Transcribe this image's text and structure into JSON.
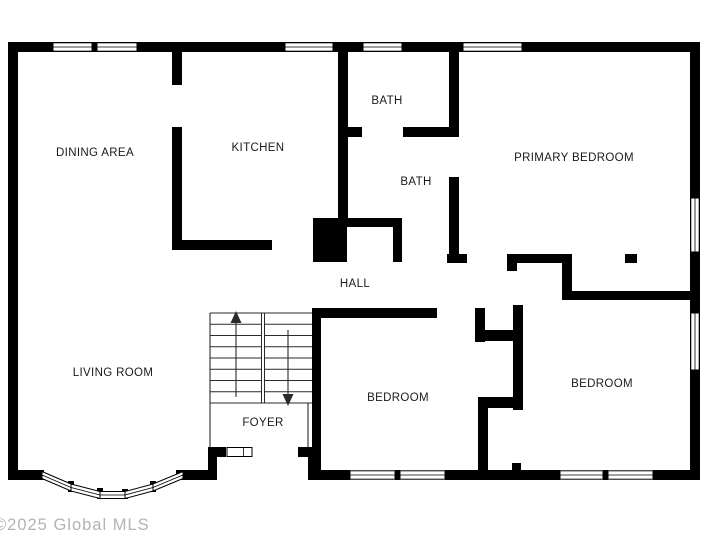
{
  "watermark": "©2025 Global MLS",
  "colors": {
    "wall": "#000000",
    "background": "#ffffff",
    "label": "#1a1a1a",
    "thin_line": "#2a2a2a",
    "watermark": "#ababab"
  },
  "rooms": {
    "dining_area": "DINING AREA",
    "kitchen": "KITCHEN",
    "bath_upper": "BATH",
    "bath_lower": "BATH",
    "primary_bedroom": "PRIMARY BEDROOM",
    "hall": "HALL",
    "living_room": "LIVING ROOM",
    "foyer": "FOYER",
    "bedroom_middle": "BEDROOM",
    "bedroom_right": "BEDROOM"
  }
}
